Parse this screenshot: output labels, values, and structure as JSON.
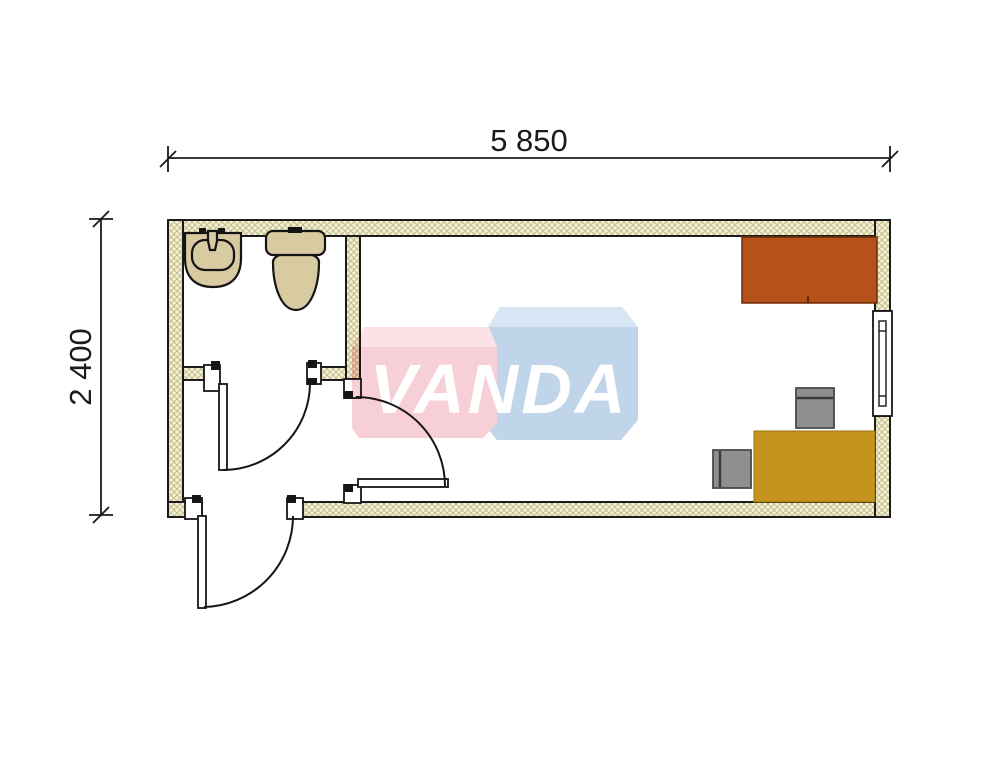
{
  "plan": {
    "kind": "container-office-floor-plan",
    "dimensions": {
      "width_label": "5 850",
      "width_mm": 5850,
      "height_label": "2 400",
      "height_mm": 2400
    },
    "rooms": [
      "bathroom",
      "hallway",
      "office-room"
    ],
    "objects": {
      "bathroom": [
        "washbasin",
        "toilet"
      ],
      "office-room": [
        "cabinet-counter",
        "desk",
        "chair-north",
        "chair-west",
        "window-right-wall"
      ],
      "doors": [
        "bathroom-door",
        "office-door",
        "entrance-door"
      ]
    }
  },
  "watermark": {
    "text": "VANDA",
    "text_color": "#ffffff",
    "front_slab_color": "#f7cfd6",
    "front_slab_top_color": "#fbe2e6",
    "back_slab_color": "#c0d4ea",
    "back_slab_top_color": "#d7e5f4"
  },
  "colors": {
    "background": "#ffffff",
    "line": "#1b1b1b",
    "wall_fill": "#f4f1da",
    "wall_hatch": "#c6c08a",
    "fixture_fill": "#d8cba2",
    "cabinet_fill": "#b5521c",
    "desk_fill": "#c6941d",
    "chair_fill": "#8f8f8f"
  }
}
